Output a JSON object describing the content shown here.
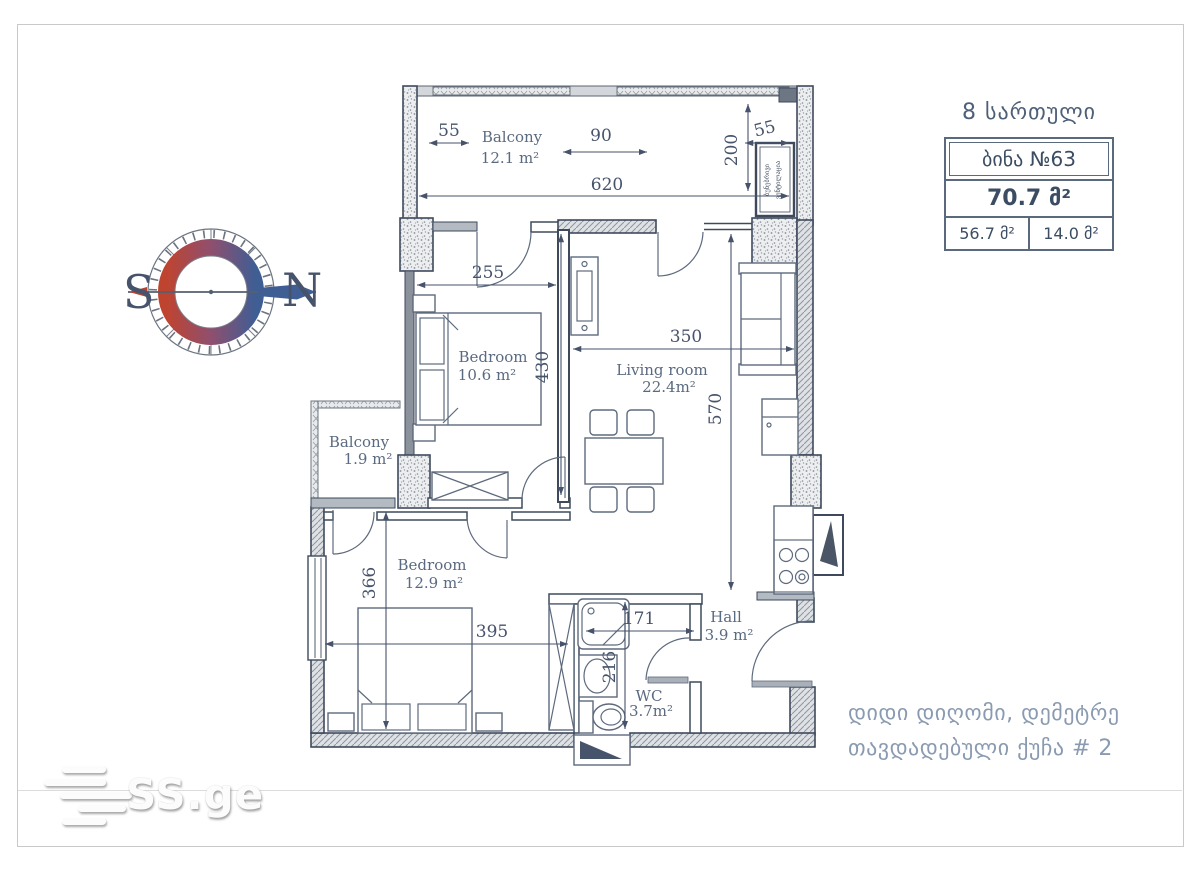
{
  "page": {
    "background": "#ffffff",
    "frame_color": "#c9c9c9"
  },
  "header": {
    "floor_label": "8 სართული"
  },
  "apartment_card": {
    "apartment_no": "ბინა №63",
    "total_area": "70.7 მ²",
    "living_area": "56.7 მ²",
    "balcony_area": "14.0 მ²"
  },
  "compass": {
    "south_label": "S",
    "north_label": "N",
    "south_color": "#b5432f",
    "north_color": "#3f5e94"
  },
  "rooms": {
    "balcony_top": {
      "name": "Balcony",
      "area": "12.1 m²"
    },
    "bedroom1": {
      "name": "Bedroom",
      "area": "10.6 m²"
    },
    "living": {
      "name": "Living room",
      "area": "22.4m²"
    },
    "balcony_left": {
      "name": "Balcony",
      "area": "1.9 m²"
    },
    "bedroom2": {
      "name": "Bedroom",
      "area": "12.9 m²"
    },
    "hall": {
      "name": "Hall",
      "area": "3.9 m²"
    },
    "wc": {
      "name": "WC",
      "area": "3.7m²"
    }
  },
  "dimensions": {
    "d55_left": "55",
    "d90": "90",
    "d55_right": "55",
    "d620": "620",
    "d200": "200",
    "d255": "255",
    "d430": "430",
    "d350": "350",
    "d570": "570",
    "d366": "366",
    "d395": "395",
    "d171": "171",
    "d216": "216"
  },
  "vent_shaft": {
    "line1": "ბუნებრივი",
    "line2": "ვენტილაცია"
  },
  "address": {
    "line1": "დიდი დიღომი, დემეტრე",
    "line2": "თავდადებული ქუჩა # 2"
  },
  "watermark": {
    "brand": "SS.ge"
  }
}
